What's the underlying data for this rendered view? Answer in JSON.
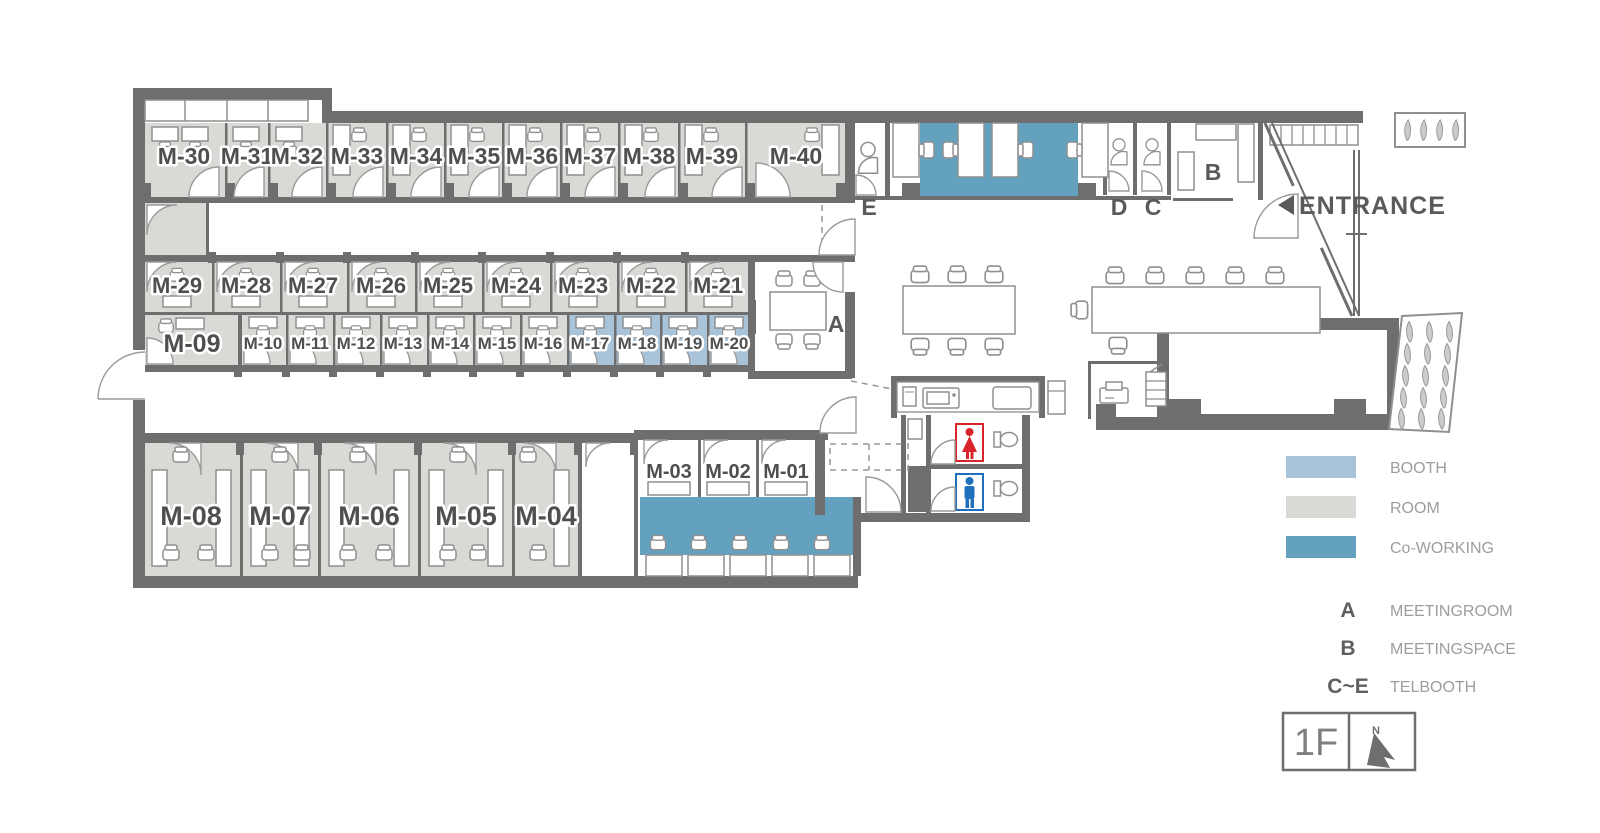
{
  "plan": {
    "rooms_top": [
      "M-30",
      "M-31",
      "M-32",
      "M-33",
      "M-34",
      "M-35",
      "M-36",
      "M-37",
      "M-38",
      "M-39",
      "M-40"
    ],
    "rooms_mid_upper": [
      "M-29",
      "M-28",
      "M-27",
      "M-26",
      "M-25",
      "M-24",
      "M-23",
      "M-22",
      "M-21"
    ],
    "rooms_mid_lower": [
      "M-09",
      "M-10",
      "M-11",
      "M-12",
      "M-13",
      "M-14",
      "M-15",
      "M-16",
      "M-17",
      "M-18",
      "M-19",
      "M-20"
    ],
    "rooms_bottom": [
      "M-08",
      "M-07",
      "M-06",
      "M-05",
      "M-04"
    ],
    "rooms_small": [
      "M-03",
      "M-02",
      "M-01"
    ],
    "zones": {
      "meeting_room": "A",
      "meeting_space": "B",
      "telbooth_c": "C",
      "telbooth_d": "D",
      "telbooth_e": "E"
    },
    "entrance_label": "ENTRANCE"
  },
  "legend": {
    "booth": {
      "label": "BOOTH",
      "color": "#a9c3d8"
    },
    "room": {
      "label": "ROOM",
      "color": "#d9d9d5"
    },
    "coworking": {
      "label": "Co-WORKING",
      "color": "#63a1bf"
    },
    "meetingroom": {
      "key": "A",
      "label": "MEETINGROOM"
    },
    "meetingspace": {
      "key": "B",
      "label": "MEETINGSPACE"
    },
    "telbooth": {
      "key": "C~E",
      "label": "TELBOOTH"
    }
  },
  "floor": {
    "label": "1F",
    "compass": "N"
  },
  "colors": {
    "wall": "#6e6e6e",
    "room": "#d9d9d5",
    "booth": "#a9c3d8",
    "coworking": "#63a1bf",
    "label_text": "#4f4f4f",
    "legend_text": "#9d9d9d",
    "women_icon": "#d8232a",
    "men_icon": "#1f6fbf"
  }
}
